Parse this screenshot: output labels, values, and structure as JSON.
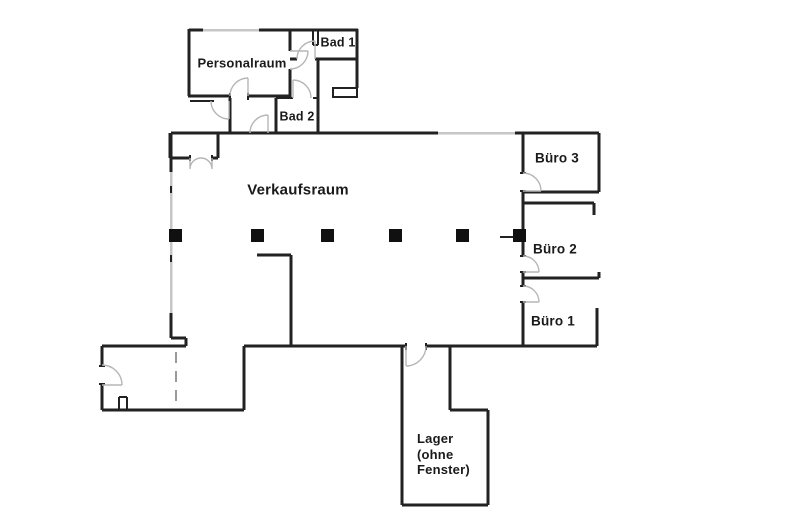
{
  "rooms": {
    "personalraum": {
      "label": "Personalraum"
    },
    "bad1": {
      "label": "Bad 1"
    },
    "bad2": {
      "label": "Bad 2"
    },
    "verkaufsraum": {
      "label": "Verkaufsraum"
    },
    "buero3": {
      "label": "Büro 3"
    },
    "buero2": {
      "label": "Büro 2"
    },
    "buero1": {
      "label": "Büro 1"
    },
    "lager": {
      "label": "Lager\n(ohne\nFenster)"
    }
  },
  "colors": {
    "wall": "#222222",
    "window": "#c6c6c6",
    "door": "#b6b6b6",
    "pillar": "#101010",
    "bg": "#ffffff",
    "label": "#1a1a1a"
  },
  "pillars": {
    "count": 6
  }
}
